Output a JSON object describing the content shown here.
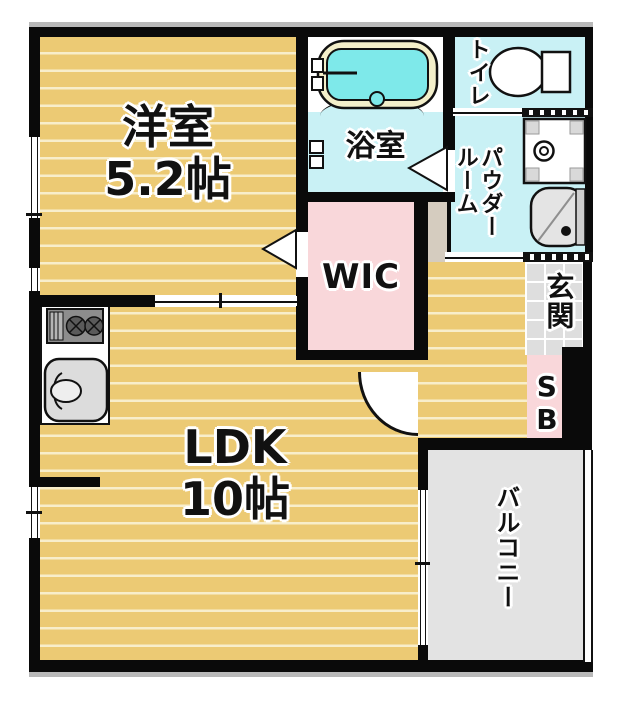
{
  "meta": {
    "title": "apartment floor plan",
    "type": "floor-plan"
  },
  "rooms": {
    "western_room": {
      "label": "洋室",
      "area": "5.2帖"
    },
    "ldk": {
      "label": "LDK",
      "area": "10帖"
    },
    "bathroom": {
      "label": "浴室"
    },
    "toilet": {
      "label": "トイレ"
    },
    "powder_room": {
      "label_line1": "パウダー",
      "label_line2": "ルーム"
    },
    "wic": {
      "label": "WIC"
    },
    "entrance": {
      "label": "玄関"
    },
    "shoe_box": {
      "label": "SB"
    },
    "balcony": {
      "label": "バルコニー"
    }
  },
  "fixtures": {
    "bathtub": "bathtub",
    "toilet_bowl": "toilet",
    "washer_pan": "washing-machine-pan",
    "vanity": "vanity-sink",
    "stove": "gas-stove",
    "kitchen_sink": "kitchen-sink"
  },
  "colors": {
    "wall": "#0a0a0a",
    "wood_floor": "#ecca74",
    "wood_stripe": "#f8eecb",
    "wet_area": "#c9f1f5",
    "closet_pink": "#f9d7da",
    "entrance_tile": "#dedede",
    "balcony_gray": "#e3e3e3",
    "hall_greige": "#d5ccbf",
    "tub_water": "#7ee9ea",
    "tub_rim": "#f3efca"
  }
}
